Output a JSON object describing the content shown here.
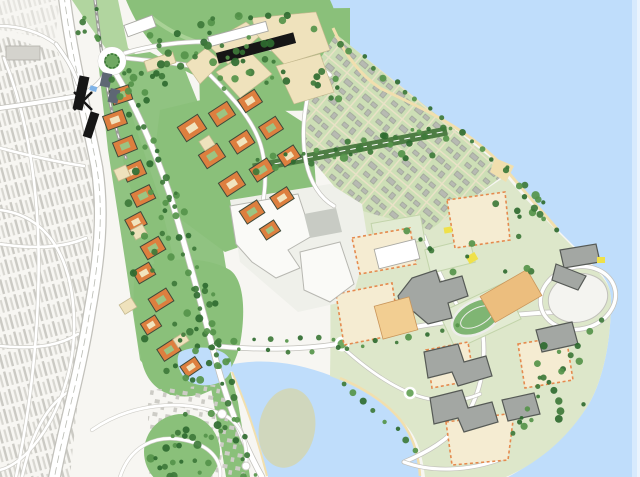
{
  "map": {
    "type": "illustrative-masterplan-site-plan",
    "palette": {
      "water": "#BFDDFB",
      "waterEdge": "#D7EAFD",
      "waterEdge2": "#EAF4FE",
      "cityBg": "#F7F6F2",
      "cityTexture": "#CBCAC4",
      "cityTexture2": "#D8D7D1",
      "roadWhite": "#FFFFFF",
      "roadCasing": "#C2C1BB",
      "laneLine": "#B8BAB2",
      "parkGreen": "#8AC07A",
      "parkLight": "#A9D296",
      "parkDark": "#4E7D44",
      "treeDark": "#3E7A3A",
      "treeMid": "#55944A",
      "treeDeep": "#2F6B30",
      "gridBg": "#CDDFB6",
      "gridStreet": "#E9E2C7",
      "gridBldg": "#B7BAB2",
      "gridBldgEdge": "#8F938B",
      "orange": "#DD7F3F",
      "orangeEdge": "#3E4A3A",
      "courtCream": "#F1E4BE",
      "courtGreen": "#9CC482",
      "cream": "#EFE2BC",
      "creamEdge": "#C4B88E",
      "black": "#161616",
      "white": "#FFFFFF",
      "industrial": "#FAFAF7",
      "industrialEdge": "#B7B7B1",
      "industrialGray": "#C8CBC4",
      "campusBg": "#DDE7CA",
      "campusParcel": "#F5ECD2",
      "dashedBorder": "#E58A4E",
      "campusGray": "#A3A7A3",
      "campusGrayEdge": "#565A56",
      "tan1": "#ECBE7E",
      "tan2": "#F2CE92",
      "trackGreen": "#7FB573",
      "trackLane": "#EDEDEA",
      "arena": "#F4F4F0",
      "sand": "#F1DFAE",
      "shallow": "#D2D6B2",
      "yellow": "#EFE14A",
      "slate": "#5E6774",
      "canopyBlue": "#7FB3E8",
      "suburbHouse": "#CDCCC6",
      "fieldFill": "#E2EBD2",
      "fieldLine": "#C2D4AA"
    },
    "orange_blocks": [
      [
        121,
        95,
        20,
        15,
        -18,
        1
      ],
      [
        115,
        120,
        21,
        15,
        -20,
        0
      ],
      [
        125,
        146,
        21,
        15,
        -22,
        1
      ],
      [
        134,
        171,
        21,
        15,
        -24,
        0
      ],
      [
        143,
        196,
        21,
        15,
        -26,
        1
      ],
      [
        136,
        222,
        18,
        14,
        -28,
        0
      ],
      [
        153,
        248,
        21,
        15,
        -30,
        1
      ],
      [
        144,
        273,
        19,
        14,
        -30,
        0
      ],
      [
        161,
        300,
        21,
        15,
        -32,
        1
      ],
      [
        151,
        325,
        17,
        13,
        -32,
        0
      ],
      [
        169,
        350,
        20,
        14,
        -33,
        1
      ],
      [
        191,
        367,
        18,
        13,
        -34,
        0
      ],
      [
        192,
        128,
        24,
        17,
        -33,
        0
      ],
      [
        222,
        114,
        22,
        16,
        -33,
        1
      ],
      [
        250,
        101,
        20,
        15,
        -33,
        0
      ],
      [
        212,
        156,
        22,
        16,
        -33,
        1
      ],
      [
        242,
        142,
        21,
        15,
        -33,
        0
      ],
      [
        271,
        128,
        20,
        15,
        -33,
        1
      ],
      [
        232,
        184,
        22,
        16,
        -33,
        0
      ],
      [
        262,
        170,
        21,
        15,
        -33,
        1
      ],
      [
        289,
        156,
        19,
        14,
        -33,
        0
      ],
      [
        252,
        212,
        21,
        15,
        -33,
        1
      ],
      [
        282,
        198,
        20,
        14,
        -33,
        0
      ],
      [
        270,
        230,
        17,
        13,
        -33,
        1
      ]
    ],
    "cream_blocks": [
      [
        160,
        62,
        30,
        11,
        -18
      ],
      [
        122,
        173,
        13,
        12,
        -24
      ],
      [
        139,
        232,
        13,
        11,
        -28
      ],
      [
        128,
        306,
        14,
        11,
        -32
      ],
      [
        181,
        340,
        13,
        10,
        -33
      ],
      [
        207,
        143,
        12,
        11,
        -33
      ]
    ],
    "slate_blocks": [
      [
        106,
        80,
        10,
        14,
        12
      ],
      [
        114,
        96,
        10,
        14,
        14
      ]
    ],
    "station_bars": [
      [
        81,
        93,
        10,
        34,
        12
      ],
      [
        91,
        125,
        9,
        26,
        18
      ]
    ],
    "cream_parcels": [
      [
        207,
        44,
        246,
        22,
        262,
        34,
        228,
        64
      ],
      [
        252,
        18,
        316,
        12,
        330,
        50,
        284,
        64,
        256,
        34
      ],
      [
        216,
        72,
        250,
        52,
        272,
        74,
        240,
        98
      ],
      [
        276,
        66,
        320,
        54,
        334,
        92,
        294,
        104
      ],
      [
        186,
        64,
        206,
        48,
        222,
        62,
        200,
        84
      ]
    ],
    "campus_parcels": [
      [
        447,
        200,
        505,
        192,
        510,
        240,
        455,
        248
      ],
      [
        352,
        238,
        410,
        228,
        416,
        264,
        360,
        274
      ],
      [
        336,
        294,
        392,
        283,
        400,
        334,
        344,
        345
      ],
      [
        446,
        422,
        514,
        413,
        508,
        460,
        452,
        465
      ],
      [
        518,
        344,
        566,
        336,
        573,
        380,
        525,
        388
      ],
      [
        426,
        350,
        468,
        342,
        474,
        380,
        432,
        388
      ]
    ],
    "campus_gray_buildings": [
      "M398,296 L412,278 L436,270 L440,282 L462,276 L468,296 L448,303 L452,318 L428,324 L414,312 L402,310 Z",
      "M424,352 L458,344 L464,362 L486,356 L492,376 L458,386 L452,372 L428,378 Z",
      "M430,398 L462,390 L468,408 L492,402 L498,422 L464,432 L458,418 L434,424 Z",
      "M536,330 L572,322 L578,344 L542,352 Z",
      "M560,250 L596,244 L600,262 L564,268 Z",
      "M502,400 L534,393 L540,414 L508,421 Z",
      "M556,264 L586,276 L578,290 L552,280 Z"
    ],
    "white_buildings": [
      [
        238,
        34,
        60,
        10,
        -15
      ],
      [
        140,
        26,
        30,
        12,
        -20
      ],
      [
        397,
        254,
        42,
        20,
        -14
      ]
    ],
    "black_buildings": [
      [
        256,
        48,
        80,
        11,
        -15
      ]
    ],
    "tan_buildings": [
      [
        511,
        296,
        54,
        30,
        -30,
        "tan1"
      ],
      [
        396,
        318,
        36,
        34,
        -15,
        "tan2"
      ]
    ],
    "sports_fields": [
      [
        398,
        232,
        50,
        26,
        -10
      ],
      [
        450,
        256,
        46,
        24,
        -14
      ],
      [
        480,
        316,
        72,
        40,
        -25
      ]
    ],
    "yellow_accents": [
      [
        472,
        258,
        10,
        8,
        -30
      ],
      [
        601,
        260,
        8,
        6,
        0
      ],
      [
        448,
        230,
        8,
        6,
        -10
      ]
    ],
    "tree_zones": [
      [
        232,
        48,
        92,
        44,
        46,
        1
      ],
      [
        188,
        330,
        50,
        52,
        26,
        2
      ],
      [
        182,
        452,
        36,
        26,
        20,
        3
      ],
      [
        470,
        252,
        82,
        48,
        11,
        4
      ],
      [
        552,
        408,
        42,
        28,
        8,
        5
      ],
      [
        152,
        210,
        26,
        95,
        16,
        6
      ],
      [
        395,
        150,
        55,
        38,
        7,
        7
      ],
      [
        150,
        82,
        26,
        20,
        10,
        8
      ],
      [
        520,
        200,
        28,
        22,
        9,
        9
      ],
      [
        200,
        420,
        30,
        16,
        7,
        10
      ],
      [
        92,
        25,
        16,
        22,
        8,
        12
      ],
      [
        560,
        360,
        28,
        38,
        8,
        13
      ],
      [
        330,
        86,
        22,
        18,
        8,
        14
      ]
    ],
    "tree_strips": [
      [
        340,
        42,
        505,
        168,
        16,
        21
      ],
      [
        508,
        172,
        556,
        228,
        6,
        22
      ],
      [
        600,
        320,
        510,
        432,
        10,
        23
      ],
      [
        345,
        382,
        415,
        450,
        8,
        24
      ],
      [
        255,
        162,
        446,
        126,
        13,
        25
      ],
      [
        256,
        172,
        447,
        136,
        11,
        26
      ],
      [
        114,
        78,
        168,
        200,
        8,
        27
      ],
      [
        168,
        200,
        212,
        348,
        9,
        28
      ],
      [
        212,
        348,
        246,
        476,
        8,
        29
      ],
      [
        122,
        72,
        176,
        196,
        8,
        30
      ],
      [
        176,
        196,
        220,
        344,
        9,
        31
      ],
      [
        220,
        344,
        255,
        472,
        8,
        32
      ],
      [
        218,
        340,
        336,
        338,
        8,
        33
      ],
      [
        218,
        352,
        336,
        350,
        6,
        34
      ],
      [
        345,
        350,
        460,
        326,
        8,
        35
      ]
    ]
  }
}
